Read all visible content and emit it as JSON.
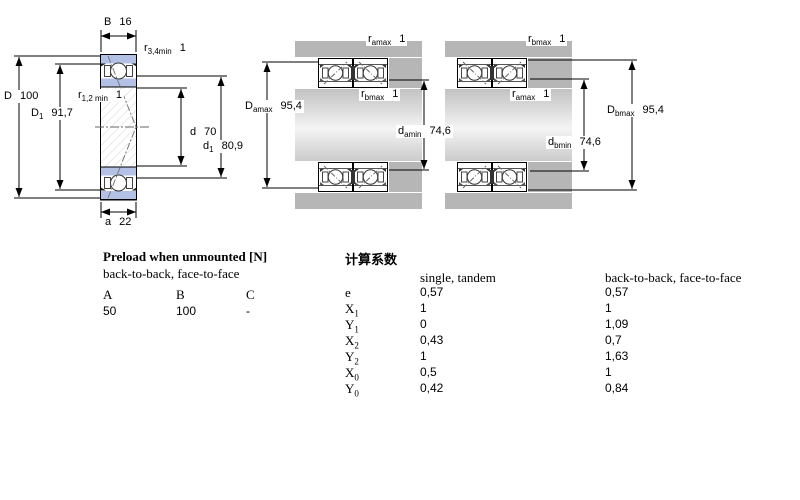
{
  "colors": {
    "bearing_ring_fill": "#b4c1e6",
    "housing_gray": "#b6b6b6",
    "line_black": "#000000"
  },
  "diagram_left": {
    "name": "single bearing cross-section",
    "labels": {
      "B": {
        "main": "B",
        "sub": "",
        "value": "16"
      },
      "r34": {
        "main": "r",
        "sub": "3,4min",
        "value": "1"
      },
      "D": {
        "main": "D",
        "sub": "",
        "value": "100"
      },
      "D1": {
        "main": "D",
        "sub": "1",
        "value": "91,7"
      },
      "r12": {
        "main": "r",
        "sub": "1,2 min",
        "value": "1"
      },
      "d": {
        "main": "d",
        "sub": "",
        "value": "70"
      },
      "d1": {
        "main": "d",
        "sub": "1",
        "value": "80,9"
      },
      "a": {
        "main": "a",
        "sub": "",
        "value": "22"
      }
    }
  },
  "diagram_middle": {
    "name": "paired bearings back-to-back mounting",
    "labels": {
      "ramax": {
        "main": "r",
        "sub": "amax",
        "value": "1"
      },
      "Damax": {
        "main": "D",
        "sub": "amax",
        "value": "95,4"
      },
      "rbmax": {
        "main": "r",
        "sub": "bmax",
        "value": "1"
      },
      "damin": {
        "main": "d",
        "sub": "amin",
        "value": "74,6"
      }
    }
  },
  "diagram_right": {
    "name": "paired bearings face-to-face mounting",
    "labels": {
      "rbmax": {
        "main": "r",
        "sub": "bmax",
        "value": "1"
      },
      "ramax": {
        "main": "r",
        "sub": "amax",
        "value": "1"
      },
      "dbmin": {
        "main": "d",
        "sub": "bmin",
        "value": "74,6"
      },
      "Dbmax": {
        "main": "D",
        "sub": "bmax",
        "value": "95,4"
      }
    }
  },
  "preload_table": {
    "title": "Preload when unmounted [N]",
    "subtitle": "back-to-back, face-to-face",
    "columns": [
      "A",
      "B",
      "C"
    ],
    "values": [
      "50",
      "100",
      "-"
    ]
  },
  "factors_table": {
    "title": "计算系数",
    "col1_header": "single, tandem",
    "col2_header": "back-to-back, face-to-face",
    "rows": [
      {
        "label": "e",
        "sub": "",
        "single": "0,57",
        "paired": "0,57"
      },
      {
        "label": "X",
        "sub": "1",
        "single": "1",
        "paired": "1"
      },
      {
        "label": "Y",
        "sub": "1",
        "single": "0",
        "paired": "1,09"
      },
      {
        "label": "X",
        "sub": "2",
        "single": "0,43",
        "paired": "0,7"
      },
      {
        "label": "Y",
        "sub": "2",
        "single": "1",
        "paired": "1,63"
      },
      {
        "label": "X",
        "sub": "0",
        "single": "0,5",
        "paired": "1"
      },
      {
        "label": "Y",
        "sub": "0",
        "single": "0,42",
        "paired": "0,84"
      }
    ]
  }
}
